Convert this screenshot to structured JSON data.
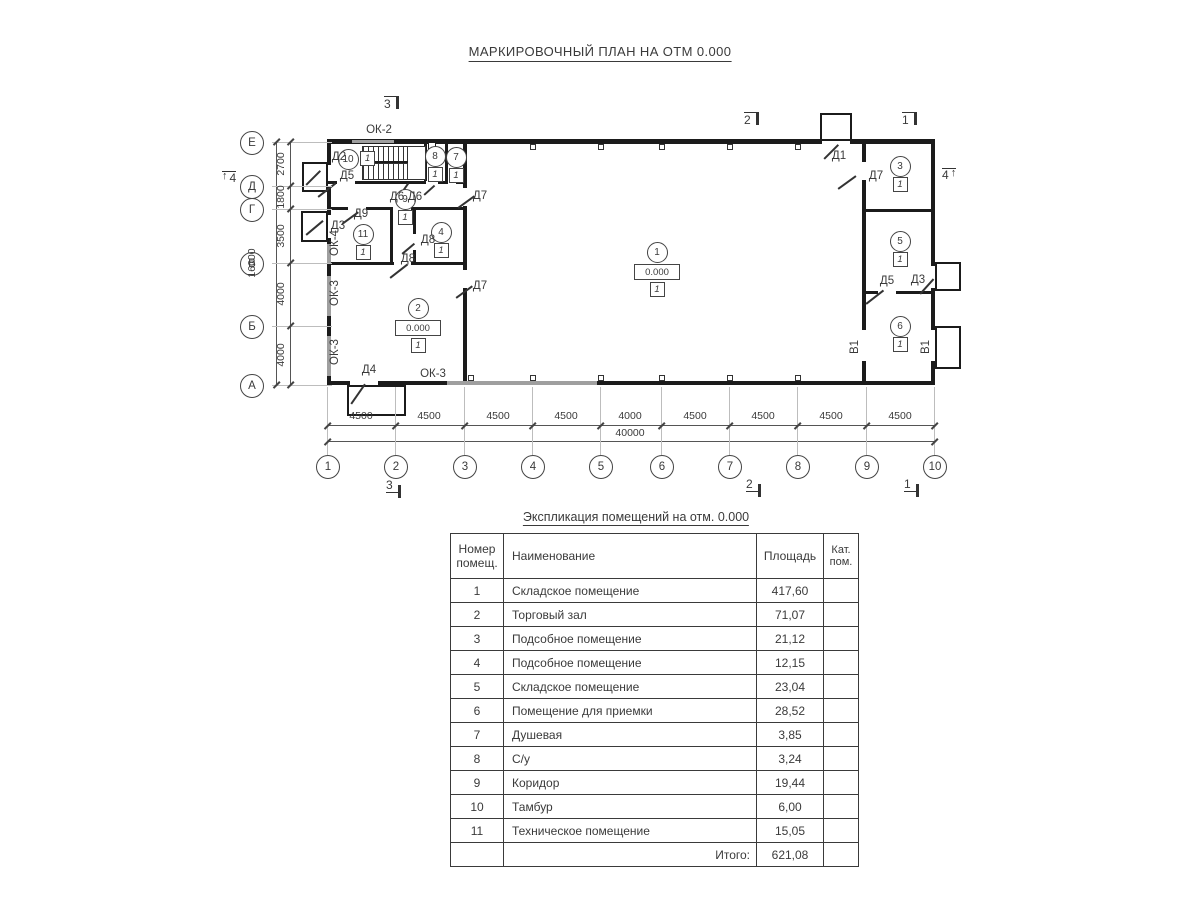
{
  "title": "МАРКИРОВОЧНЫЙ ПЛАН НА ОТМ 0.000",
  "plan": {
    "axis_letters": [
      {
        "t": "Е",
        "y": 142
      },
      {
        "t": "Д",
        "y": 186
      },
      {
        "t": "Г",
        "y": 209
      },
      {
        "t": "В",
        "y": 263
      },
      {
        "t": "Б",
        "y": 326
      },
      {
        "t": "А",
        "y": 385
      }
    ],
    "axis_numbers": [
      {
        "t": "1",
        "x": 327
      },
      {
        "t": "2",
        "x": 395
      },
      {
        "t": "3",
        "x": 464
      },
      {
        "t": "4",
        "x": 532
      },
      {
        "t": "5",
        "x": 600
      },
      {
        "t": "6",
        "x": 661
      },
      {
        "t": "7",
        "x": 729
      },
      {
        "t": "8",
        "x": 797
      },
      {
        "t": "9",
        "x": 866
      },
      {
        "t": "10",
        "x": 934
      }
    ],
    "v_dims": [
      {
        "t": "2700",
        "y": 164
      },
      {
        "t": "1800",
        "y": 197
      },
      {
        "t": "3500",
        "y": 236
      },
      {
        "t": "4000",
        "y": 294
      },
      {
        "t": "4000",
        "y": 355
      }
    ],
    "v_total": {
      "t": "16000",
      "x": 252,
      "y": 263
    },
    "h_dims": [
      {
        "t": "4500",
        "x": 361
      },
      {
        "t": "4500",
        "x": 429
      },
      {
        "t": "4500",
        "x": 498
      },
      {
        "t": "4500",
        "x": 566
      },
      {
        "t": "4000",
        "x": 630
      },
      {
        "t": "4500",
        "x": 695
      },
      {
        "t": "4500",
        "x": 763
      },
      {
        "t": "4500",
        "x": 831
      },
      {
        "t": "4500",
        "x": 900
      }
    ],
    "h_total": {
      "t": "40000",
      "x": 630,
      "y": 433
    },
    "section_marks_top": [
      {
        "t": "3",
        "x": 384,
        "y": 96
      },
      {
        "t": "2",
        "x": 744,
        "y": 112
      },
      {
        "t": "1",
        "x": 902,
        "y": 112
      }
    ],
    "section_marks_bottom": [
      {
        "t": "3",
        "x": 386,
        "y": 479
      },
      {
        "t": "2",
        "x": 746,
        "y": 478
      },
      {
        "t": "1",
        "x": 904,
        "y": 478
      }
    ],
    "section_mark_left": {
      "t": "4",
      "x": 222,
      "y": 171
    },
    "section_mark_right": {
      "t": "4",
      "x": 942,
      "y": 168
    },
    "rooms": [
      {
        "num": "1",
        "x": 656,
        "y": 251,
        "elev": "0.000",
        "cat": "1"
      },
      {
        "num": "2",
        "x": 417,
        "y": 307,
        "elev": "0.000",
        "cat": "1"
      },
      {
        "num": "3",
        "x": 899,
        "y": 165,
        "cat": "1"
      },
      {
        "num": "4",
        "x": 440,
        "y": 231,
        "cat": "1"
      },
      {
        "num": "5",
        "x": 899,
        "y": 240,
        "cat": "1"
      },
      {
        "num": "6",
        "x": 899,
        "y": 325,
        "cat": "1"
      },
      {
        "num": "7",
        "x": 455,
        "y": 156,
        "cat": "1"
      },
      {
        "num": "8",
        "x": 434,
        "y": 155,
        "cat": "1"
      },
      {
        "num": "9",
        "x": 404,
        "y": 198,
        "cat": "1"
      },
      {
        "num": "10",
        "x": 347,
        "y": 158,
        "cat": "1",
        "layout": "h"
      },
      {
        "num": "11",
        "x": 362,
        "y": 233,
        "cat": "1"
      }
    ],
    "door_labels": [
      {
        "t": "Д1",
        "x": 839,
        "y": 156
      },
      {
        "t": "Д2",
        "x": 339,
        "y": 157
      },
      {
        "t": "Д5",
        "x": 347,
        "y": 176
      },
      {
        "t": "Д6",
        "x": 397,
        "y": 197
      },
      {
        "t": "Д6",
        "x": 415,
        "y": 197
      },
      {
        "t": "Д7",
        "x": 480,
        "y": 196
      },
      {
        "t": "Д9",
        "x": 361,
        "y": 214
      },
      {
        "t": "Д3",
        "x": 338,
        "y": 226
      },
      {
        "t": "Д8",
        "x": 428,
        "y": 240
      },
      {
        "t": "Д8",
        "x": 408,
        "y": 259
      },
      {
        "t": "Д7",
        "x": 480,
        "y": 286
      },
      {
        "t": "Д4",
        "x": 369,
        "y": 370
      },
      {
        "t": "Д7",
        "x": 876,
        "y": 176
      },
      {
        "t": "Д5",
        "x": 887,
        "y": 281
      },
      {
        "t": "Д3",
        "x": 918,
        "y": 280
      },
      {
        "t": "В1",
        "x": 855,
        "y": 347,
        "rot": 1
      },
      {
        "t": "В1",
        "x": 926,
        "y": 347,
        "rot": 1
      }
    ],
    "window_labels": [
      {
        "t": "ОК-2",
        "x": 379,
        "y": 130
      },
      {
        "t": "ОК-4",
        "x": 335,
        "y": 243,
        "rot": 1
      },
      {
        "t": "ОК-3",
        "x": 335,
        "y": 293,
        "rot": 1
      },
      {
        "t": "ОК-3",
        "x": 335,
        "y": 352,
        "rot": 1
      },
      {
        "t": "ОК-3",
        "x": 433,
        "y": 374
      }
    ]
  },
  "schedule": {
    "title": "Экспликация помещений на отм. 0.000",
    "headers": [
      "Номер\nпомещ.",
      "Наименование",
      "Площадь",
      "Кат.\nпом."
    ],
    "rows": [
      {
        "num": "1",
        "name": "Складское помещение",
        "area": "417,60",
        "cat": ""
      },
      {
        "num": "2",
        "name": "Торговый зал",
        "area": "71,07",
        "cat": ""
      },
      {
        "num": "3",
        "name": "Подсобное помещение",
        "area": "21,12",
        "cat": ""
      },
      {
        "num": "4",
        "name": "Подсобное помещение",
        "area": "12,15",
        "cat": ""
      },
      {
        "num": "5",
        "name": "Складское помещение",
        "area": "23,04",
        "cat": ""
      },
      {
        "num": "6",
        "name": "Помещение для приемки",
        "area": "28,52",
        "cat": ""
      },
      {
        "num": "7",
        "name": "Душевая",
        "area": "3,85",
        "cat": ""
      },
      {
        "num": "8",
        "name": "С/у",
        "area": "3,24",
        "cat": ""
      },
      {
        "num": "9",
        "name": "Коридор",
        "area": "19,44",
        "cat": ""
      },
      {
        "num": "10",
        "name": "Тамбур",
        "area": "6,00",
        "cat": ""
      },
      {
        "num": "11",
        "name": "Техническое помещение",
        "area": "15,05",
        "cat": ""
      }
    ],
    "total_label": "Итого:",
    "total_value": "621,08"
  }
}
